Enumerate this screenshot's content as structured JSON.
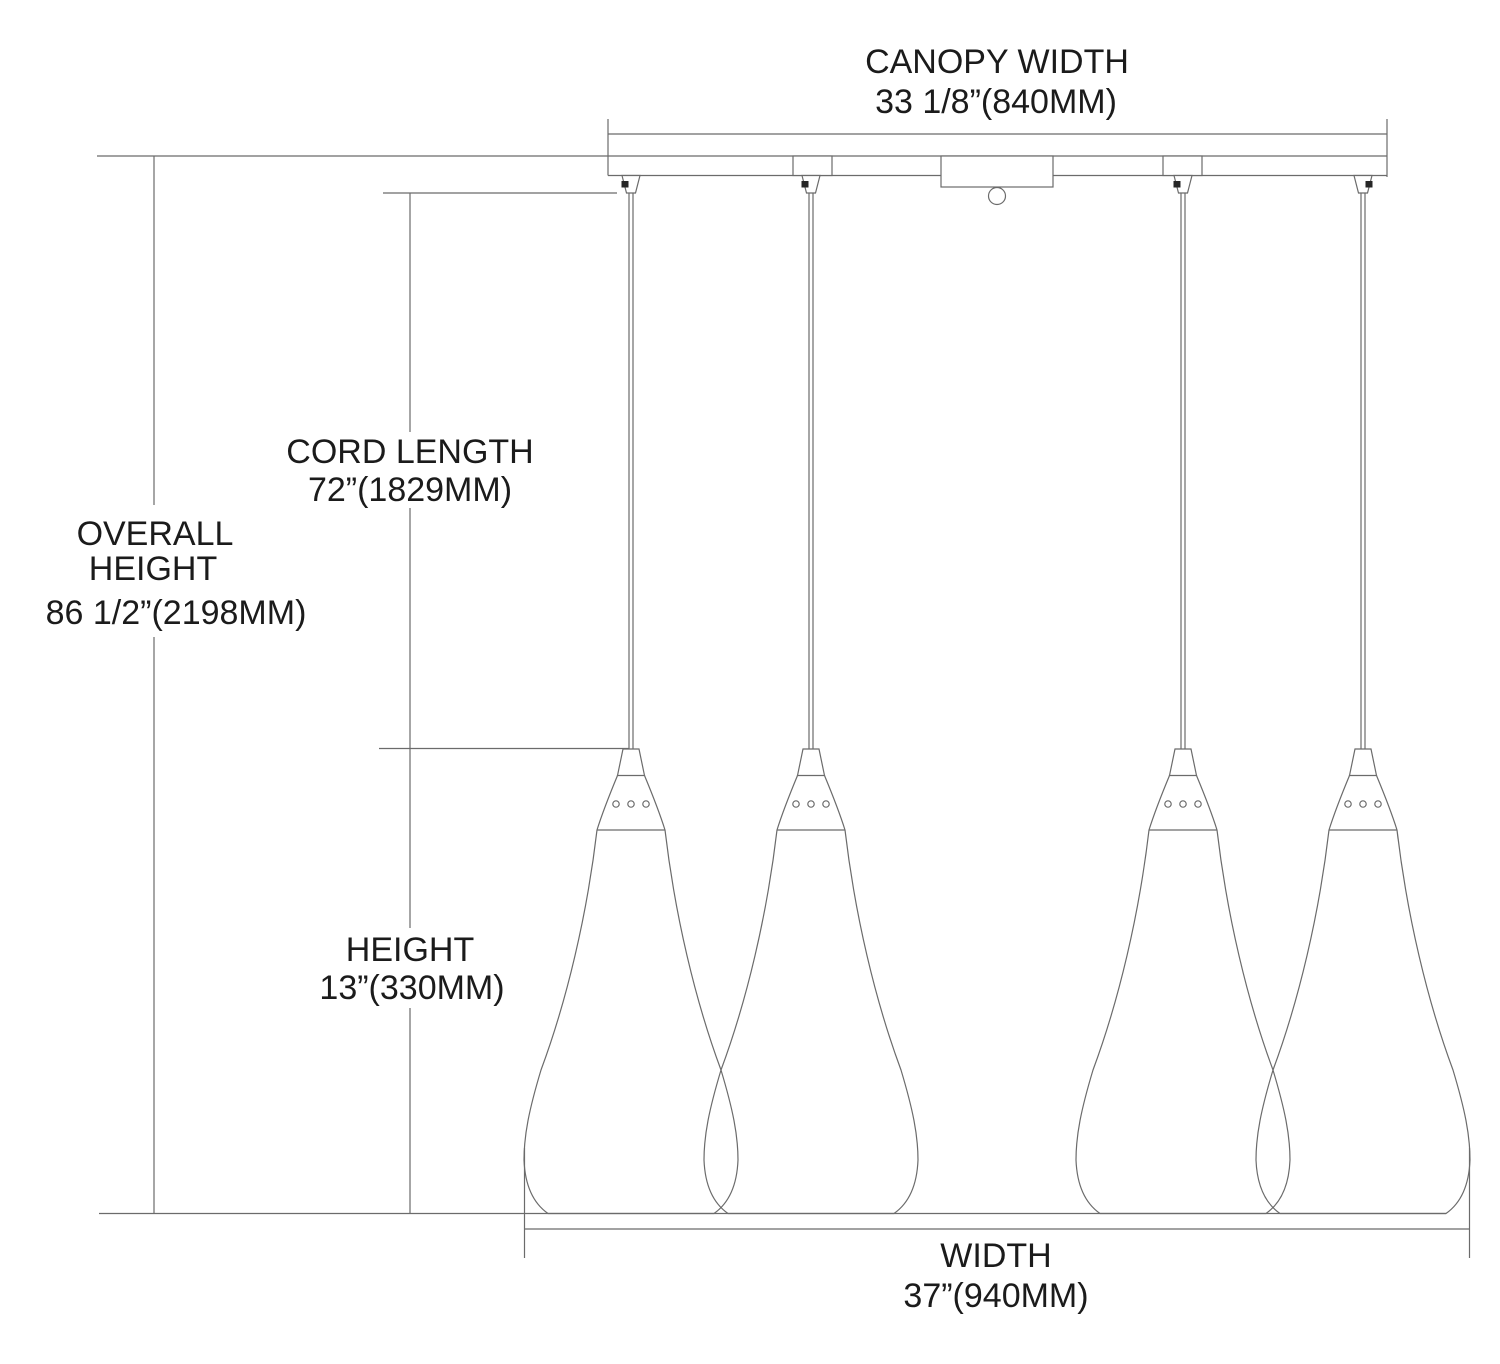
{
  "figure": {
    "type": "pendant-light-dimension-diagram",
    "pendant_count": 4,
    "light_count_visible_in_drawing": 4
  },
  "colors": {
    "background": "#ffffff",
    "line": "#6b6b6b",
    "text": "#1b1b1b",
    "knob": "#262626"
  },
  "dims": {
    "canopy_width": {
      "label": "CANOPY WIDTH",
      "value": "33 1/8”(840MM)"
    },
    "cord_length": {
      "label": "CORD LENGTH",
      "value": "72”(1829MM)"
    },
    "overall_height": {
      "label_line1": "OVERALL",
      "label_line2": "HEIGHT",
      "value": "86 1/2”(2198MM)"
    },
    "height": {
      "label": "HEIGHT",
      "value": "13”(330MM)"
    },
    "width": {
      "label": "WIDTH",
      "value": "37”(940MM)"
    }
  }
}
